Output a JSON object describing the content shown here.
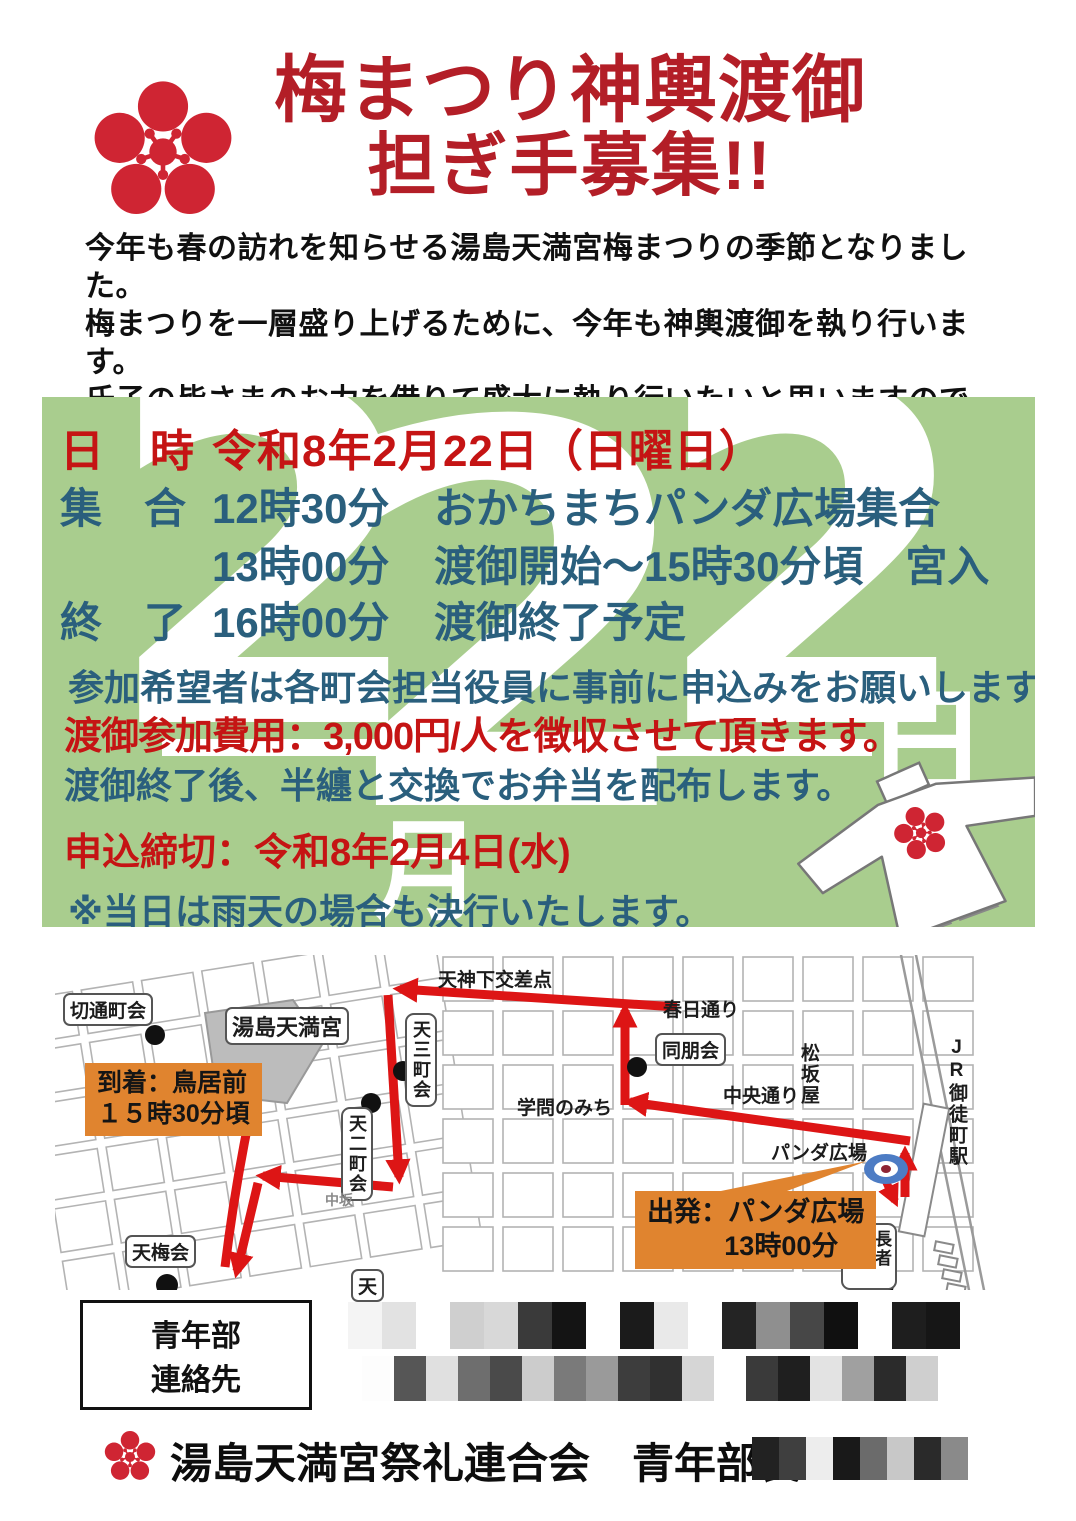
{
  "header": {
    "logo_icon": "plum-blossom-crest",
    "title_line1": "梅まつり神輿渡御",
    "title_line2": "担ぎ手募集!!"
  },
  "intro": {
    "lines": [
      "今年も春の訪れを知らせる湯島天満宮梅まつりの季節となりました。",
      "梅まつりを一層盛り上げるために、今年も神輿渡御を執り行います。",
      "氏子の皆さまのお力を借りて盛大に執り行いたいと思いますので、",
      "是非、ご参加ご協力のほどよろしくお願いいたします。"
    ]
  },
  "schedule": {
    "watermark": {
      "text": "2月22日",
      "d1": "2",
      "month": "月",
      "d2": "2",
      "d3": "2",
      "day": "日"
    },
    "date_label": "日　時",
    "date_value": "令和8年2月22日（日曜日）",
    "rows": [
      {
        "label": "集　合",
        "time": "12時30分",
        "desc": "おかちまちパンダ広場集合"
      },
      {
        "label": "",
        "time": "13時00分",
        "desc": "渡御開始～15時30分頃　宮入"
      },
      {
        "label": "終　了",
        "time": "16時00分",
        "desc": "渡御終了予定"
      }
    ],
    "note1": "参加希望者は各町会担当役員に事前に申込みをお願いします。",
    "fee_note": "渡御参加費用：3,000円/人を徴収させて頂きます。",
    "note2": "渡御終了後、半纏と交換でお弁当を配布します。",
    "deadline": "申込締切：令和8年2月4日(水)",
    "rain_note": "※当日は雨天の場合も決行いたします。"
  },
  "map": {
    "labels": {
      "kiritoshi": "切通町会",
      "yushima": "湯島天満宮",
      "tenjinshita": "天神下交差点",
      "kasuga_dori": "春日通り",
      "domeikai": "同朋会",
      "matsuzakaya": "松坂屋",
      "chuo_dori": "中央通り",
      "gakumon": "学問のみち",
      "jr_okachimachi": "JR御徒町駅",
      "panda_hiroba": "パンダ広場",
      "chojamachi": "長者町一",
      "tenbaikai": "天梅会",
      "ten2": "天二町会",
      "ten3": "天三町会",
      "nakasaka": "中坂",
      "ten_partial": "天"
    },
    "callout_arrival": {
      "line1": "到着：鳥居前",
      "line2": "１５時30分頃"
    },
    "callout_departure": {
      "line1": "出発：パンダ広場",
      "line2": "13時00分"
    }
  },
  "contact": {
    "label_line1": "青年部",
    "label_line2": "連絡先",
    "mosaic_row1": [
      "#f4f4f4",
      "#e2e2e2",
      "#ffffff",
      "#cfcfcf",
      "#d8d8d8",
      "#3a3a3a",
      "#141414",
      "#ffffff",
      "#1b1b1b",
      "#e9e9e9",
      "#ffffff",
      "#242424",
      "#8f8f8f",
      "#474747",
      "#101010",
      "#ffffff",
      "#1e1e1e",
      "#161616"
    ],
    "mosaic_row2": [
      "#fdfdfd",
      "#565656",
      "#e0e0e0",
      "#6e6e6e",
      "#4a4a4a",
      "#cccccc",
      "#7a7a7a",
      "#9a9a9a",
      "#3d3d3d",
      "#303030",
      "#d6d6d6",
      "#ffffff",
      "#3a3a3a",
      "#1f1f1f",
      "#e3e3e3",
      "#a0a0a0",
      "#2b2b2b",
      "#cfcfcf"
    ]
  },
  "footer": {
    "organization": "湯島天満宮祭礼連合会　青年部長",
    "name_mosaic": [
      "#222222",
      "#3f3f3f",
      "#ededed",
      "#191919",
      "#6b6b6b",
      "#c8c8c8",
      "#2a2a2a",
      "#8a8a8a"
    ]
  },
  "colors": {
    "title_red": "#b31e27",
    "accent_red": "#c51414",
    "text_teal": "#2a5f7d",
    "box_green": "#a9cd8e",
    "callout_orange": "#e0842f",
    "route_red": "#dd1515",
    "crest_red": "#cf2533"
  }
}
